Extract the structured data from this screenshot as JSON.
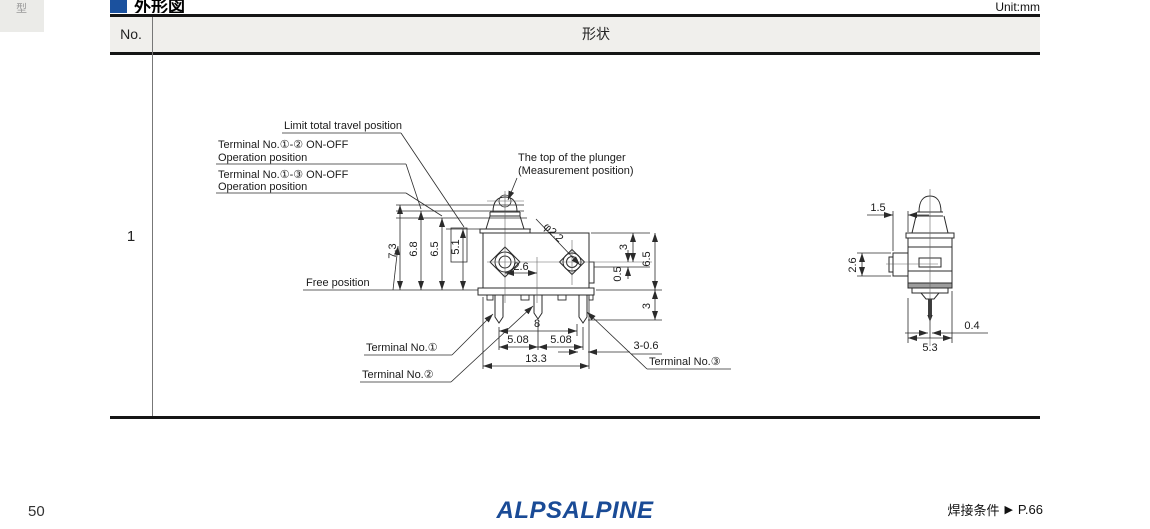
{
  "page": {
    "side_tab": "型",
    "section_title": "外形図",
    "unit_label": "Unit:mm",
    "page_number": "50",
    "logo_text": "ALPSALPINE",
    "footer_link": {
      "text": "焊接条件",
      "arrow": "▶",
      "page_ref": "P.66"
    }
  },
  "table": {
    "headers": {
      "no": "No.",
      "shape": "形状"
    },
    "rows": [
      {
        "no": "1"
      }
    ]
  },
  "drawing": {
    "labels": {
      "limit_total_travel": "Limit total travel position",
      "terminal_1_2_line1": "Terminal No.①-② ON-OFF",
      "terminal_1_2_line2": "Operation position",
      "terminal_1_3_line1": "Terminal No.①-③ ON-OFF",
      "terminal_1_3_line2": "Operation position",
      "plunger_top_line1": "The top of the plunger",
      "plunger_top_line2": "(Measurement position)",
      "free_position": "Free position",
      "terminal_no1": "Terminal No.①",
      "terminal_no2": "Terminal No.②",
      "terminal_no3": "Terminal No.③"
    },
    "dimensions": {
      "free_height": "7.3",
      "op_1_2_height": "6.8",
      "op_1_3_height": "6.5",
      "limit_height": "5.1",
      "hole_diameter": "φ2.2",
      "hole_offset": "2.6",
      "right_top": "3",
      "right_step": "0.5",
      "right_body": "6.5",
      "right_pin": "3",
      "pin_span": "8",
      "pitch_left": "5.08",
      "pitch_right": "5.08",
      "overall_width": "13.3",
      "pin_width": "3-0.6",
      "side_offset": "1.5",
      "side_button": "2.6",
      "side_pin_width": "0.4",
      "side_width": "5.3"
    },
    "colors": {
      "accent_blue": "#1b519e",
      "line": "#2b2b2b"
    }
  }
}
